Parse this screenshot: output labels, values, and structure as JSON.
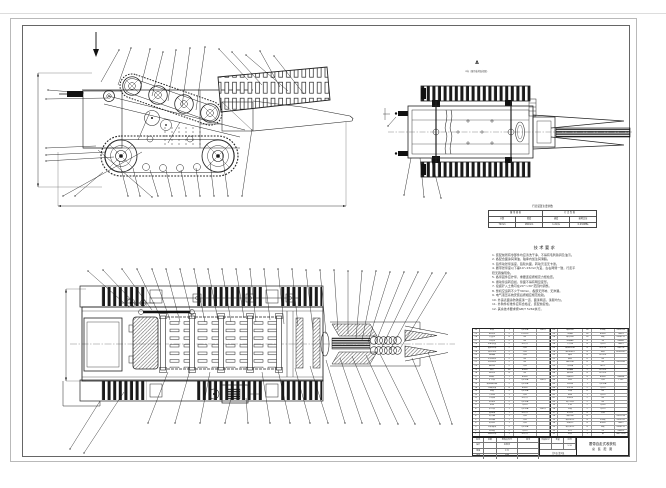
{
  "views": {
    "a_label": "A",
    "a_caption": "A向（履带着地面视图）"
  },
  "param_table": {
    "caption": "行走装置主要参数",
    "row1": [
      "履 带 规 格",
      "行 走 性 能"
    ],
    "row2": [
      "节距",
      "宽度",
      "速度",
      "接地比压"
    ],
    "row3": [
      "72mm",
      "180mm",
      "1.2m/s",
      "0.032MPa"
    ]
  },
  "notes": {
    "title": "技术要求",
    "lines": [
      "1. 装配前所有零部件均应清洗干净，不得有毛刺铁屑及油污。",
      "2. 各配合面涂润滑油，轴承内加注润滑脂。",
      "3. 链传动张紧适度，链轮共面，转动灵活无卡滞。",
      "4. 履带张紧度以下垂10～15mm为宜，左右两侧一致，行走平",
      "   稳无跑偏现象。",
      "5. 各紧固件应拧紧，重要连接按规定力矩检查。",
      "6. 振动筛运转自如，筛面不得有明显变形。",
      "7. 挖掘铲入土角可在20°～30°范围内调整。",
      "8. 整机空运转不少于30min，各部无异响、无渗漏。",
      "9. 电气液压系统安装后按相应规范检验。",
      "10. 外露表面涂防锈底漆一道、面漆两道，漆膜均匀。",
      "11. 外购件标准件应有合格证，装配前复检。",
      "12. 其余技术要求按GB/T 5262执行。"
    ]
  },
  "bom": {
    "rows": [
      [
        "30",
        "机架",
        "1",
        "Q235A",
        "焊接件",
        "60",
        "螺栓M8",
        "16",
        "8.8级",
        "GB5783"
      ],
      [
        "29",
        "驱动轮",
        "2",
        "ZG310",
        "",
        "59",
        "垫圈8",
        "16",
        "65Mn",
        "GB93"
      ],
      [
        "28",
        "支重轮",
        "8",
        "45",
        "",
        "58",
        "螺母M8",
        "16",
        "8级",
        "GB6170"
      ],
      [
        "27",
        "导向轮",
        "2",
        "45",
        "",
        "57",
        "销轴B6",
        "4",
        "35",
        "GB882"
      ],
      [
        "26",
        "张紧装置",
        "2",
        "组合件",
        "",
        "56",
        "开口销",
        "4",
        "Q215",
        "GB91"
      ],
      [
        "25",
        "履带总成",
        "2",
        "外购",
        "",
        "55",
        "轴承6206",
        "4",
        "GCr15",
        "GB276"
      ],
      [
        "24",
        "液压马达",
        "2",
        "外购",
        "",
        "54",
        "油封FB25",
        "4",
        "橡胶",
        "HG4-692"
      ],
      [
        "23",
        "减速器",
        "1",
        "外购",
        "",
        "53",
        "端盖",
        "4",
        "HT200",
        ""
      ],
      [
        "22",
        "主动链轮",
        "2",
        "45",
        "",
        "52",
        "轴套",
        "6",
        "45",
        ""
      ],
      [
        "21",
        "从动链轮",
        "2",
        "45",
        "",
        "51",
        "键8×40",
        "6",
        "45",
        "GB1096"
      ],
      [
        "20",
        "输送链",
        "2",
        "外购",
        "",
        "50",
        "传动轴",
        "2",
        "40Cr",
        ""
      ],
      [
        "19",
        "筛杆",
        "36",
        "65Mn",
        "",
        "49",
        "联轴器",
        "2",
        "HT200",
        ""
      ],
      [
        "18",
        "振动轮",
        "4",
        "45",
        "",
        "48",
        "轴承座",
        "4",
        "HT200",
        ""
      ],
      [
        "17",
        "挖掘铲",
        "1",
        "65Mn",
        "",
        "47",
        "挡圈25",
        "4",
        "65Mn",
        "GB894"
      ],
      [
        "16",
        "铲刀架",
        "1",
        "Q235A",
        "焊接件",
        "46",
        "电机",
        "1",
        "外购",
        "Y132"
      ],
      [
        "15",
        "螺旋输送器",
        "2",
        "Q235A",
        "",
        "45",
        "电机座",
        "1",
        "Q235A",
        ""
      ],
      [
        "14",
        "压缩弹簧",
        "4",
        "65Mn",
        "",
        "44",
        "防护罩",
        "2",
        "Q215",
        ""
      ],
      [
        "13",
        "侧板",
        "2",
        "Q235A",
        "",
        "43",
        "托辊",
        "6",
        "45",
        ""
      ],
      [
        "12",
        "升运链",
        "1",
        "外购",
        "",
        "42",
        "链罩",
        "1",
        "Q215",
        ""
      ],
      [
        "11",
        "分离筛",
        "1",
        "组合件",
        "",
        "41",
        "张紧轮",
        "2",
        "45",
        ""
      ],
      [
        "10",
        "限深轮",
        "2",
        "Q235A",
        "",
        "40",
        "调节丝杠",
        "2",
        "45",
        ""
      ],
      [
        "9",
        "机罩",
        "1",
        "Q215",
        "",
        "39",
        "手柄",
        "2",
        "Q235",
        ""
      ],
      [
        "8",
        "牵引架",
        "1",
        "Q235A",
        "焊接件",
        "38",
        "盖板",
        "2",
        "Q215",
        ""
      ],
      [
        "7",
        "变速箱",
        "1",
        "组合件",
        "",
        "37",
        "密封垫",
        "4",
        "石棉",
        ""
      ],
      [
        "6",
        "离合器",
        "1",
        "外购",
        "",
        "36",
        "油杯M6",
        "8",
        "",
        "GB1154"
      ],
      [
        "5",
        "制动器",
        "1",
        "外购",
        "",
        "35",
        "螺栓M12",
        "8",
        "8.8级",
        "GB5782"
      ],
      [
        "4",
        "发动机",
        "1",
        "外购",
        "",
        "34",
        "垫圈12",
        "8",
        "65Mn",
        "GB97"
      ],
      [
        "3",
        "车架横梁",
        "2",
        "Q235A",
        "",
        "33",
        "螺母M12",
        "8",
        "8级",
        "GB6170"
      ],
      [
        "2",
        "挡泥板",
        "2",
        "Q215",
        "",
        "32",
        "吊环",
        "2",
        "20",
        "GB825"
      ],
      [
        "1",
        "底盘总成",
        "1",
        "组合件",
        "",
        "31",
        "标牌",
        "1",
        "铝",
        "GB13306"
      ]
    ],
    "title_block": {
      "sign_rows": [
        [
          "标记",
          "处数",
          "更改文件号",
          "签字"
        ],
        [
          "设计",
          "",
          "标准化",
          ""
        ],
        [
          "审核",
          "",
          "工艺",
          ""
        ],
        [
          "批准",
          "",
          "日期",
          ""
        ]
      ],
      "stage_labels": [
        "阶段标记",
        "重量",
        "比例"
      ],
      "stage_values": [
        "",
        "",
        "1:10"
      ],
      "sheet_note": "共1张 第1张",
      "title1": "履带自走式收获机",
      "title2": "总 装 配 图"
    }
  }
}
